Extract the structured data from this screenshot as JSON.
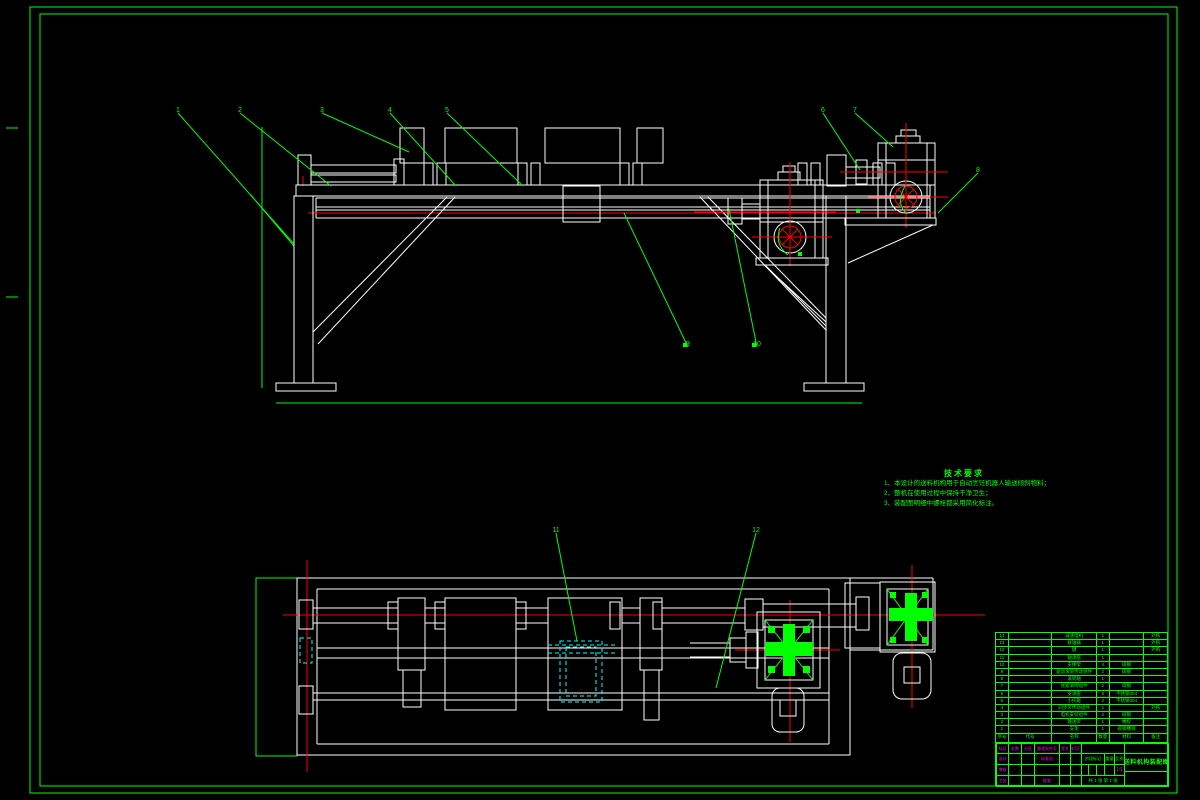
{
  "colors": {
    "line_green": "#00ff00",
    "line_white": "#ffffff",
    "center_red": "#ff0000",
    "hidden_cyan": "#00ffff",
    "text_magenta": "#ff00ff",
    "background": "#000000"
  },
  "tech_requirements": {
    "title": "技术要求",
    "items": [
      "1、本设计的送料机构用于自动烹饪机器人输送倾斜物料；",
      "2、整机在使用过程中保持干净卫生；",
      "3、装配图明细中螺栓都采用简化标注。"
    ]
  },
  "balloons": [
    {
      "label": "1",
      "x": 178,
      "y": 110,
      "tx": 294,
      "ty": 244
    },
    {
      "label": "2",
      "x": 240,
      "y": 110,
      "tx": 331,
      "ty": 186
    },
    {
      "label": "3",
      "x": 322,
      "y": 110,
      "tx": 409,
      "ty": 152
    },
    {
      "label": "4",
      "x": 390,
      "y": 110,
      "tx": 456,
      "ty": 186
    },
    {
      "label": "5",
      "x": 447,
      "y": 110,
      "tx": 523,
      "ty": 186
    },
    {
      "label": "6",
      "x": 823,
      "y": 110,
      "tx": 860,
      "ty": 170
    },
    {
      "label": "7",
      "x": 855,
      "y": 110,
      "tx": 893,
      "ty": 147
    },
    {
      "label": "8",
      "x": 978,
      "y": 170,
      "tx": 938,
      "ty": 213
    },
    {
      "label": "9",
      "x": 688,
      "y": 344,
      "tx": 624,
      "ty": 213,
      "sq": true
    },
    {
      "label": "10",
      "x": 757,
      "y": 344,
      "tx": 729,
      "ty": 209,
      "sq": true
    },
    {
      "label": "11",
      "x": 556,
      "y": 530,
      "tx": 577,
      "ty": 641
    },
    {
      "label": "12",
      "x": 756,
      "y": 530,
      "tx": 716,
      "ty": 688
    }
  ],
  "leader_marks": [
    {
      "x": 858,
      "y": 211
    },
    {
      "x": 800,
      "y": 254
    }
  ],
  "bom": {
    "headers": [
      "序号",
      "代号",
      "名称",
      "数量",
      "材料",
      "备注"
    ],
    "rows": [
      {
        "no": "14",
        "code": "",
        "name": "减速电机",
        "qty": "1",
        "material": "",
        "remark": "外购"
      },
      {
        "no": "13",
        "code": "",
        "name": "联轴器",
        "qty": "1",
        "material": "",
        "remark": "外购"
      },
      {
        "no": "12",
        "code": "",
        "name": "键",
        "qty": "1",
        "material": "",
        "remark": "外购"
      },
      {
        "no": "11",
        "code": "",
        "name": "轴承座",
        "qty": "1",
        "material": "",
        "remark": ""
      },
      {
        "no": "10",
        "code": "",
        "name": "支撑架",
        "qty": "4",
        "material": "碳钢",
        "remark": ""
      },
      {
        "no": "9",
        "code": "",
        "name": "驱动滚筒传动组件",
        "qty": "2",
        "material": "碳钢",
        "remark": ""
      },
      {
        "no": "8",
        "code": "",
        "name": "滚筒轴",
        "qty": "1",
        "material": "",
        "remark": ""
      },
      {
        "no": "7",
        "code": "",
        "name": "张紧滚筒组件",
        "qty": "2",
        "material": "碳钢",
        "remark": ""
      },
      {
        "no": "6",
        "code": "",
        "name": "支承座",
        "qty": "8",
        "material": "不锈钢304",
        "remark": ""
      },
      {
        "no": "5",
        "code": "",
        "name": "小托辊",
        "qty": "2",
        "material": "不锈钢304",
        "remark": ""
      },
      {
        "no": "4",
        "code": "",
        "name": "同步带传动组件",
        "qty": "1",
        "material": "",
        "remark": "外购"
      },
      {
        "no": "3",
        "code": "",
        "name": "电机安装组件",
        "qty": "2",
        "material": "碳钢",
        "remark": ""
      },
      {
        "no": "2",
        "code": "",
        "name": "输送带",
        "qty": "1",
        "material": "橡胶",
        "remark": ""
      },
      {
        "no": "1",
        "code": "",
        "name": "支架",
        "qty": "1",
        "material": "碳钢槽钢",
        "remark": ""
      }
    ]
  },
  "title_block": {
    "revision_headers": [
      "标记",
      "处数",
      "分区",
      "更改文件号",
      "签名",
      "年月日"
    ],
    "row_design": "设计",
    "row_check": "审核",
    "row_process": "工艺",
    "row_standard": "标准化",
    "row_approve": "批准",
    "stage_label": "阶段标记",
    "weight_label": "重量",
    "scale_label": "比例",
    "scale_value": "1:1",
    "sheet_note": "共 1 张 第 1 张",
    "drawing_title": "送料机构装配图"
  }
}
